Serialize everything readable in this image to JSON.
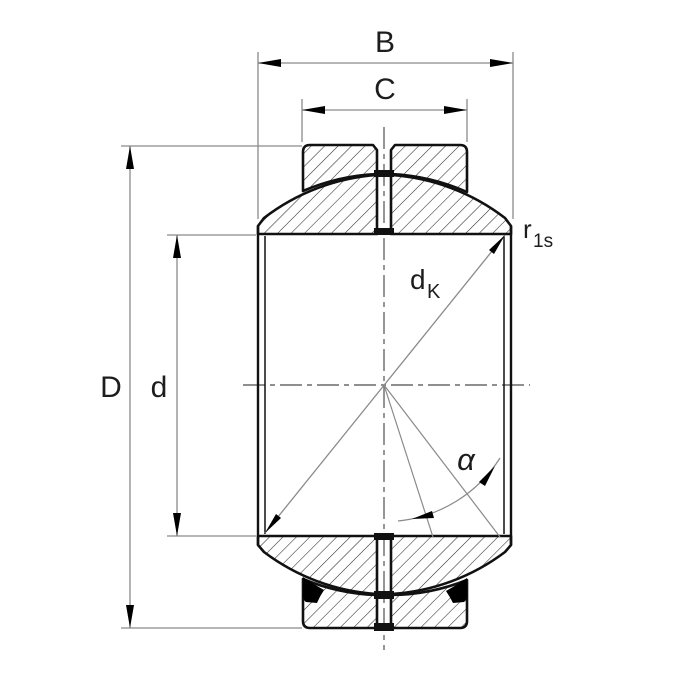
{
  "drawing": {
    "type": "engineering-cross-section",
    "subject": "spherical plain bearing",
    "labels": {
      "width_total": "B",
      "width_outer_ring": "C",
      "outside_diameter": "D",
      "bore_diameter": "d",
      "sphere_diameter_base": "d",
      "sphere_diameter_sub": "K",
      "chamfer_radius_base": "r",
      "chamfer_radius_sub": "1s",
      "tilt_angle": "α"
    },
    "colors": {
      "background": "#ffffff",
      "outline": "#111111",
      "hatch": "#2a2a2a",
      "dimension_line": "#8a8a8a",
      "centerline": "#6a6a6a",
      "arrow": "#000000",
      "seal": "#000000",
      "label": "#1d1d1d"
    }
  }
}
